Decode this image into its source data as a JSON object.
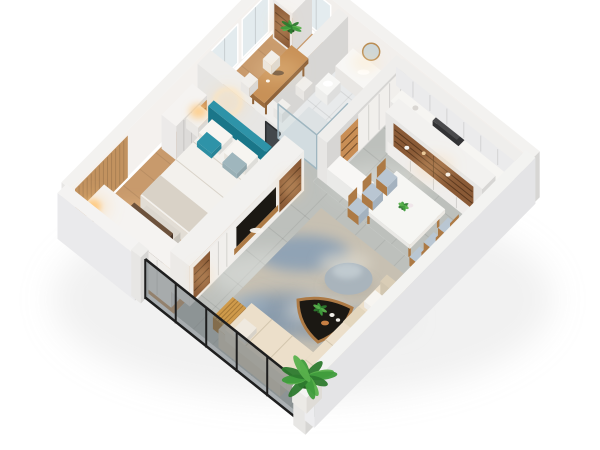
{
  "scene": {
    "description": "isometric cutaway 3D floor plan render of an apartment",
    "view": "dollhouse isometric from above",
    "background": "#ffffff"
  },
  "palette": {
    "wall": "#efeeec",
    "wallTop": "#f3f2f0",
    "wallLight": "#f5f3f1",
    "innerWall": "#f4f1ee",
    "woodFloor": "#c89a6c",
    "woodSlat": "#c2925f",
    "tile": "#bdc0bc",
    "tileLight": "#d3d6d2",
    "bathTile": "#e8eaeb",
    "rugBase": "#c7c0b2",
    "rugBlue": "#7e9ab6",
    "rugBlueDark": "#5f82a6",
    "rugLight": "#dfdacf",
    "sofa": "#e9dfcc",
    "sofaShade": "#d9cdb6",
    "sofaBack": "#e2d7c2",
    "teal": "#1b7a8e",
    "tealLight": "#2e93a8",
    "woodWarm": "#8a5a36",
    "woodLit": "#c98e55",
    "woodMid": "#ad7a45",
    "walnut": "#5a4330",
    "dark": "#1b1813",
    "hood": "#3a3a3c",
    "frame": "#1e1e1e",
    "marble": "#f4f4f1",
    "cushion": "#b9c6d2",
    "plantGreen": "#3f9c3c",
    "plantDark": "#2d7a2e",
    "glow": "#ffc97e",
    "mirror": "#43484c",
    "pot": "#f5f4f2",
    "bedding": "#f3f1ed",
    "blanket": "#d9d2c7",
    "counter": "#f6f5f2"
  },
  "rooms": [
    {
      "id": "master-bedroom",
      "furniture": [
        "double-bed",
        "teal-headboard",
        "nightstands",
        "table-lamps",
        "wardrobe-row",
        "walnut-dresser",
        "bench",
        "floor-lamp",
        "halo-wall-light",
        "wood-slat-panel"
      ]
    },
    {
      "id": "study",
      "furniture": [
        "wood-tea-table",
        "white-stools",
        "bookshelf",
        "windows",
        "plant"
      ]
    },
    {
      "id": "bathroom",
      "furniture": [
        "glass-shower",
        "vanity",
        "round-mirror",
        "toilet"
      ]
    },
    {
      "id": "kitchen",
      "furniture": [
        "base-cabinets",
        "upper-cabinets",
        "range-hood",
        "cooktop",
        "peninsula"
      ]
    },
    {
      "id": "dining-area",
      "furniture": [
        "marble-dining-table",
        "six-wood-chairs",
        "display-hutch",
        "centerpiece-flowers"
      ]
    },
    {
      "id": "living-room",
      "furniture": [
        "tv-media-wall",
        "sectional-sofa",
        "area-rug",
        "triangular-coffee-table",
        "ottoman",
        "slat-side-table",
        "potted-plant"
      ]
    },
    {
      "id": "balcony-edge",
      "furniture": [
        "black-framed-glass-wall"
      ]
    }
  ]
}
